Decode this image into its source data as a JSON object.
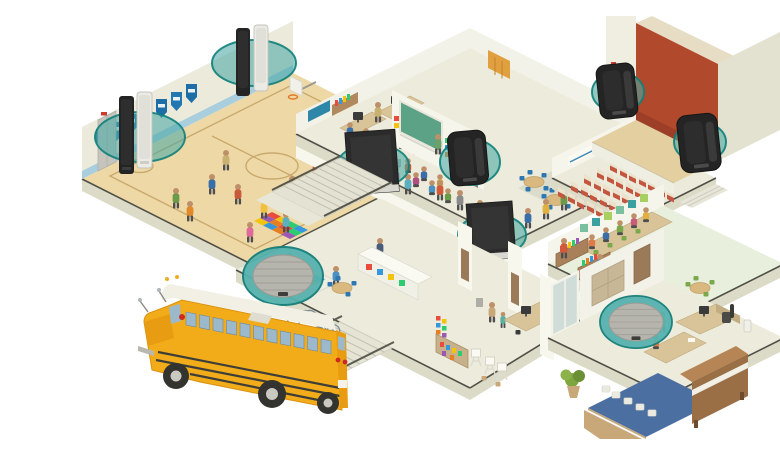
{
  "illustration": {
    "title": "Isometric cutaway illustration of a school building with a distributed loudspeaker system and a yellow school bus at the entrance",
    "background": "#ffffff"
  },
  "palette": {
    "background": "#ffffff",
    "wall": "#eceadb",
    "wall_shade": "#e3e2d0",
    "slab": "#dcdbc7",
    "slab_line": "#4f4f47",
    "floor": "#edecdc",
    "court": "#eed9a6",
    "court_line": "#c9a96d",
    "gym_stripe": "#a9cede",
    "banner_blue": "#1d6ea7",
    "stage_red": "#b14a2c",
    "seat_red": "#c4563f",
    "seat_back": "#ece2cc",
    "chalkboard": "#5ba286",
    "coverage_teal": "#4aa8a3",
    "coverage_rim": "#0f7f7a",
    "speaker_black": "#242424",
    "speaker_white": "#eceae4",
    "library_floor": "#e9efdd",
    "kitchen_blue": "#4a6fa0",
    "wood": "#b08a5e",
    "bus_yellow": "#f2ac1a",
    "bus_shade": "#e89c12",
    "bus_roof": "#f2f0e4",
    "bus_window": "#9cb9cb"
  },
  "rooms": [
    {
      "id": "gymnasium",
      "label": "Gymnasium with basketball court and pennant banners"
    },
    {
      "id": "computer-lab",
      "label": "Computer lab classroom"
    },
    {
      "id": "classroom",
      "label": "Classroom with green chalkboard"
    },
    {
      "id": "cafeteria",
      "label": "Cafeteria with round tables"
    },
    {
      "id": "auditorium",
      "label": "Auditorium with stage and red seating"
    },
    {
      "id": "library",
      "label": "Library / media center with bookshelves"
    },
    {
      "id": "hallway",
      "label": "Second-floor hallway with students"
    },
    {
      "id": "lobby",
      "label": "Entrance lobby with reception desk and stairs"
    },
    {
      "id": "offices",
      "label": "Administration offices"
    },
    {
      "id": "art-room",
      "label": "Art room with easels"
    },
    {
      "id": "music-room",
      "label": "Music room with upright piano"
    },
    {
      "id": "kitchen",
      "label": "Kitchen with dish stacks"
    },
    {
      "id": "exterior",
      "label": "Yellow school bus parked at the entrance"
    }
  ],
  "speakers": [
    {
      "type": "column-array",
      "finish": "black and white pair",
      "location": "gymnasium left wall"
    },
    {
      "type": "column-array",
      "finish": "black and white pair",
      "location": "gymnasium back wall"
    },
    {
      "type": "surface-mount",
      "finish": "black",
      "location": "classroom wall"
    },
    {
      "type": "surface-mount",
      "finish": "black",
      "location": "auditorium stage left"
    },
    {
      "type": "surface-mount",
      "finish": "black",
      "location": "auditorium stage right"
    },
    {
      "type": "flat-panel",
      "finish": "black",
      "location": "stair landing"
    },
    {
      "type": "flat-panel",
      "finish": "black",
      "location": "hallway"
    },
    {
      "type": "ceiling-mount",
      "finish": "white grille",
      "location": "lobby ceiling"
    },
    {
      "type": "ceiling-mount",
      "finish": "white grille",
      "location": "office ceiling"
    }
  ],
  "coverage_indicator_color": "#2d9f9a"
}
